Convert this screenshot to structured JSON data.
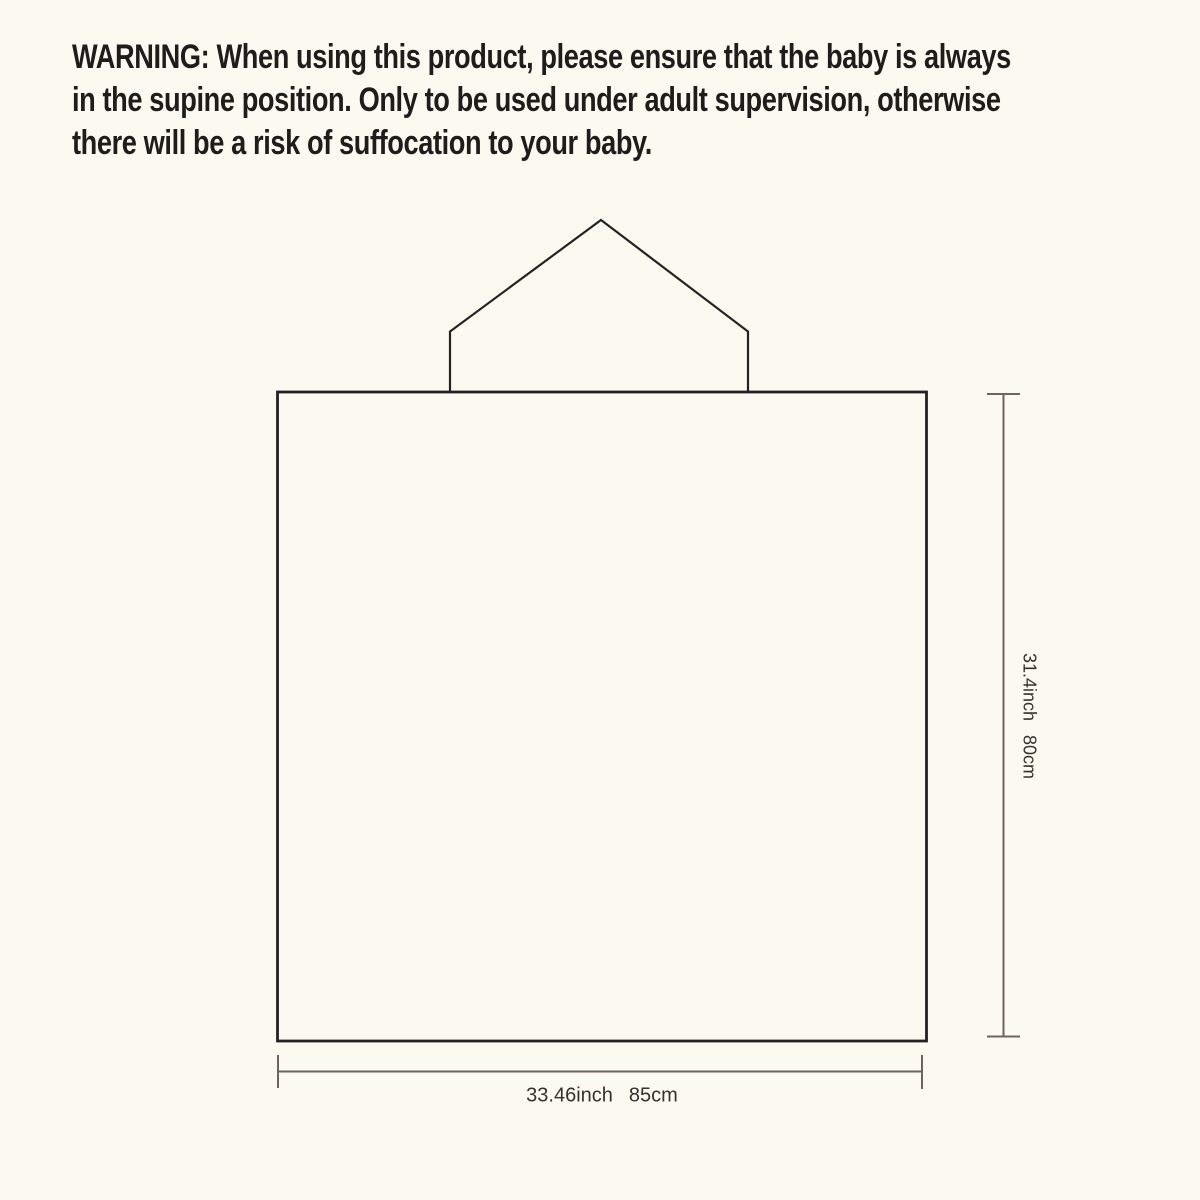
{
  "warning": {
    "lines": [
      "WARNING: When using this product, please ensure that the baby is always",
      "in the supine position. Only to be used under adult supervision, otherwise",
      "there will be a risk of suffocation to your baby."
    ]
  },
  "diagram": {
    "height_label": {
      "inch": "31.4inch",
      "cm": "80cm"
    },
    "width_label": {
      "inch": "33.46inch",
      "cm": "85cm"
    }
  },
  "colors": {
    "background": "#fcf9f1",
    "outline": "#272022",
    "dimension_line": "#6f635c",
    "warning_text": "#211c1c",
    "label_text": "#37302e"
  }
}
